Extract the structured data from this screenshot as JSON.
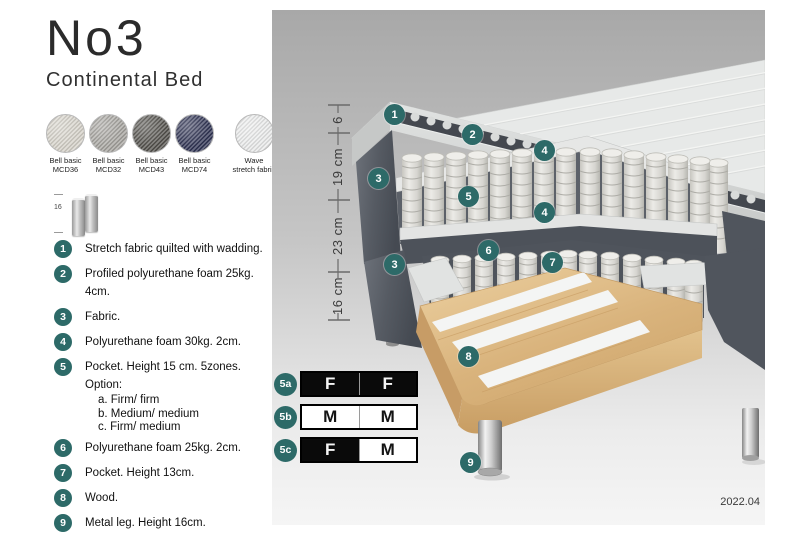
{
  "title": "No3",
  "subtitle": "Continental Bed",
  "swatches": [
    {
      "line1": "Bell basic",
      "line2": "MCD36",
      "color": "#d6d2c9"
    },
    {
      "line1": "Bell basic",
      "line2": "MCD32",
      "color": "#a5a39e"
    },
    {
      "line1": "Bell basic",
      "line2": "MCD43",
      "color": "#52504b"
    },
    {
      "line1": "Bell basic",
      "line2": "MCD74",
      "color": "#2f3353"
    },
    {
      "line1": "Wave",
      "line2": "stretch fabric",
      "color": "#eaebeb"
    }
  ],
  "leg_icon": {
    "label": "16"
  },
  "spec_items": [
    {
      "num": "1",
      "text": "Stretch fabric quilted with wadding."
    },
    {
      "num": "2",
      "text": "Profiled polyurethane foam 25kg. 4cm."
    },
    {
      "num": "3",
      "text": "Fabric."
    },
    {
      "num": "4",
      "text": "Polyurethane foam 30kg. 2cm."
    },
    {
      "num": "5",
      "text": "Pocket. Height 15 cm. 5zones. Option:",
      "options": [
        "a. Firm/ firm",
        "b. Medium/ medium",
        "c. Firm/ medium"
      ]
    },
    {
      "num": "6",
      "text": "Polyurethane foam 25kg. 2cm."
    },
    {
      "num": "7",
      "text": "Pocket. Height 13cm."
    },
    {
      "num": "8",
      "text": "Wood."
    },
    {
      "num": "9",
      "text": "Metal leg. Height 16cm."
    }
  ],
  "dimensions": [
    "6",
    "19 cm",
    "23 cm",
    "16 cm"
  ],
  "firmness": {
    "rows": [
      {
        "label": "5a",
        "cells": [
          {
            "letter": "F",
            "variant": "dark"
          },
          {
            "letter": "F",
            "variant": "dark"
          }
        ]
      },
      {
        "label": "5b",
        "cells": [
          {
            "letter": "M",
            "variant": "light"
          },
          {
            "letter": "M",
            "variant": "light"
          }
        ]
      },
      {
        "label": "5c",
        "cells": [
          {
            "letter": "F",
            "variant": "dark"
          },
          {
            "letter": "M",
            "variant": "light"
          }
        ]
      }
    ]
  },
  "callouts": [
    "1",
    "2",
    "4",
    "3",
    "5",
    "4",
    "6",
    "7",
    "3",
    "8",
    "9"
  ],
  "version": "2022.04",
  "colors": {
    "accent_teal": "#2d6a68",
    "fabric_dark": "#565b63",
    "wood": "#d9b37c",
    "spring": "#e6e5e1",
    "panel_top": "#a8a8a8",
    "panel_bottom": "#f5f5f5"
  }
}
